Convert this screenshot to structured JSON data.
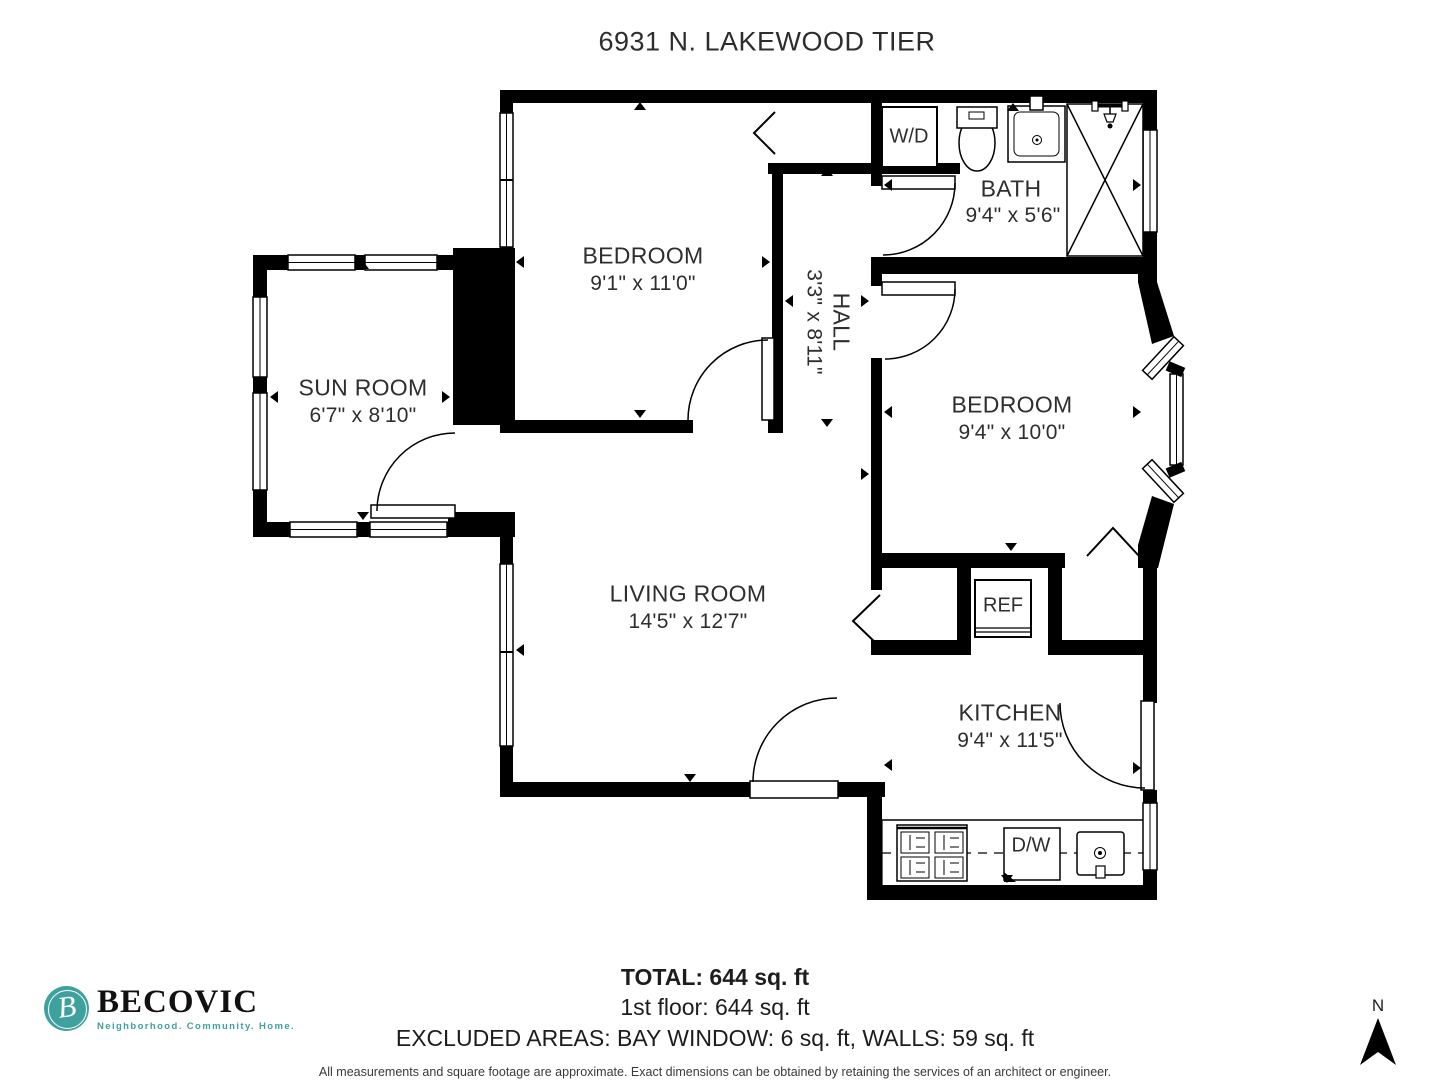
{
  "title": "6931 N. LAKEWOOD TIER",
  "rooms": {
    "bedroom_top": {
      "name": "BEDROOM",
      "dims": "9'1\" x 11'0\""
    },
    "bath": {
      "name": "BATH",
      "dims": "9'4\" x 5'6\""
    },
    "hall": {
      "name": "HALL",
      "dims": "3'3\" x 8'11\""
    },
    "sun_room": {
      "name": "SUN ROOM",
      "dims": "6'7\" x 8'10\""
    },
    "bedroom_right": {
      "name": "BEDROOM",
      "dims": "9'4\" x 10'0\""
    },
    "living_room": {
      "name": "LIVING ROOM",
      "dims": "14'5\" x 12'7\""
    },
    "kitchen": {
      "name": "KITCHEN",
      "dims": "9'4\" x 11'5\""
    }
  },
  "appliances": {
    "washer_dryer": "W/D",
    "refrigerator": "REF",
    "dishwasher": "D/W"
  },
  "summary": {
    "total": "TOTAL: 644 sq. ft",
    "first_floor": "1st floor: 644 sq. ft",
    "excluded": "EXCLUDED AREAS: BAY WINDOW: 6 sq. ft, WALLS: 59 sq. ft",
    "disclaimer": "All measurements and square footage are approximate. Exact dimensions can be obtained by retaining the services of an architect or engineer."
  },
  "logo": {
    "name": "BECOVIC",
    "monogram": "B",
    "tagline": "Neighborhood. Community. Home."
  },
  "compass": {
    "north": "N"
  },
  "colors": {
    "wall": "#000000",
    "text": "#2e2e2e",
    "brand_teal": "#3fa19e"
  }
}
